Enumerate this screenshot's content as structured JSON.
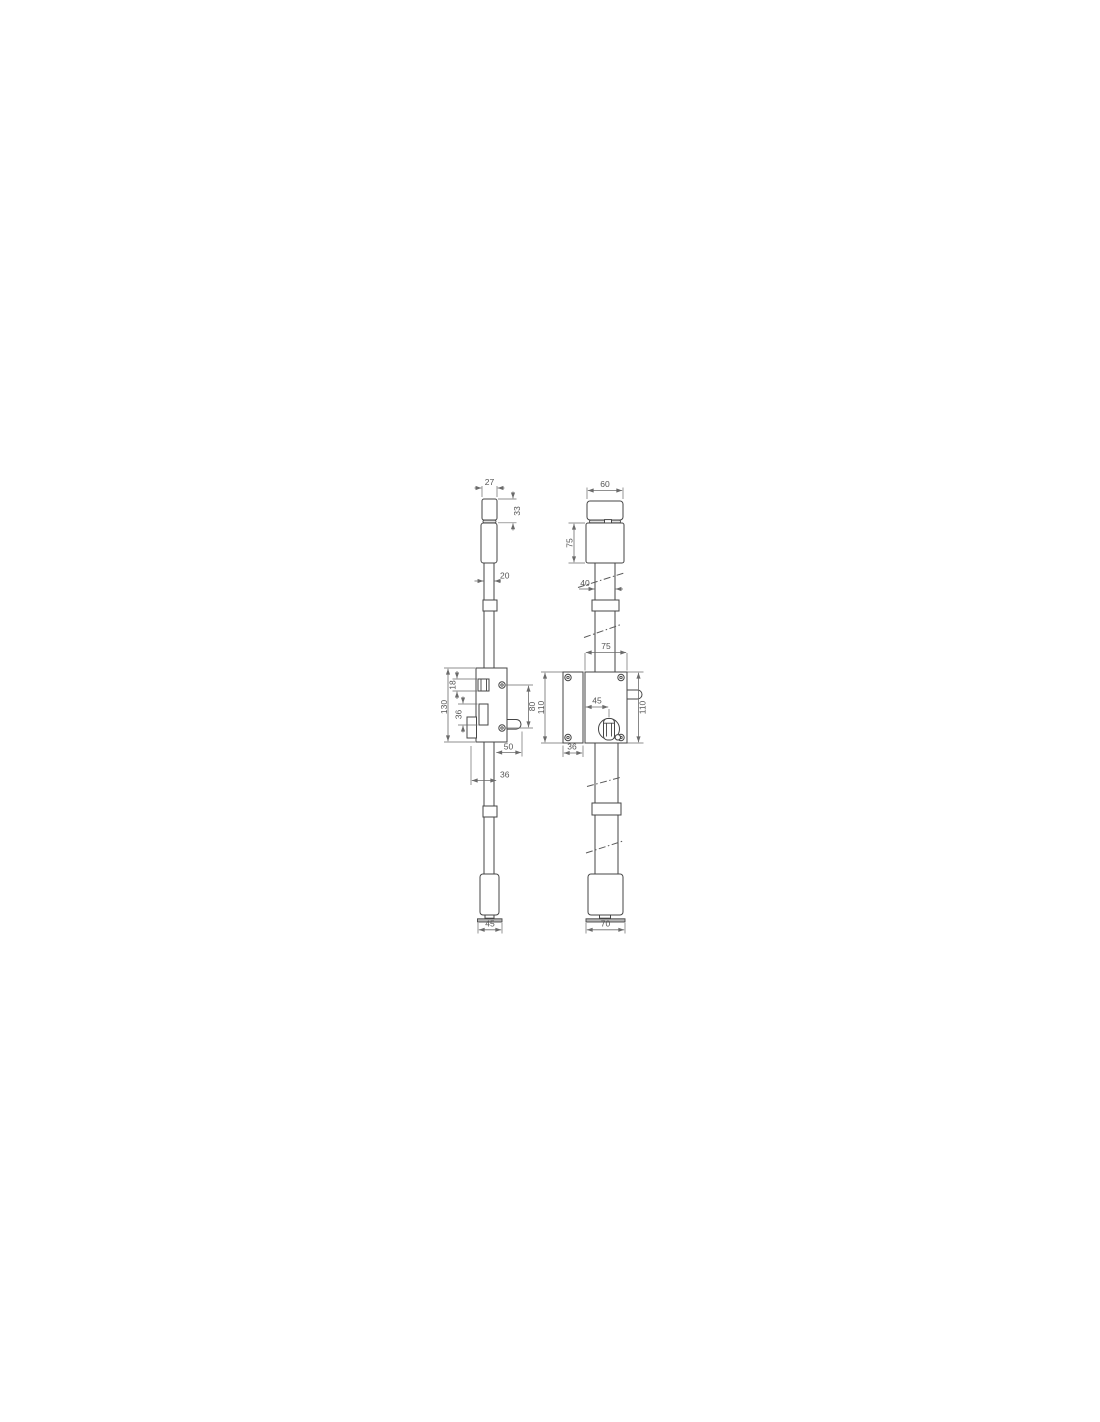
{
  "page": {
    "background": "#ffffff"
  },
  "drawing": {
    "kind": "lock-technical-drawing",
    "line_color": "#454545",
    "dim_color": "#6b6b6b",
    "views": {
      "left_label": "side-view",
      "right_label": "front-view"
    },
    "dims": {
      "left": {
        "cap_width": "27",
        "cap_height": "33",
        "rod_width": "20",
        "latch_height": "18",
        "case_height": "130",
        "slot_height": "36",
        "screw_spacing": "80",
        "bolt_reach": "50",
        "backset": "36",
        "base_width": "45"
      },
      "right": {
        "cap_width": "60",
        "body_height": "75",
        "rod_width": "40",
        "case_width": "75",
        "height_left": "110",
        "cylinder_offset": "45",
        "height_right": "110",
        "faceplate_width": "36",
        "base_width": "70"
      }
    }
  }
}
